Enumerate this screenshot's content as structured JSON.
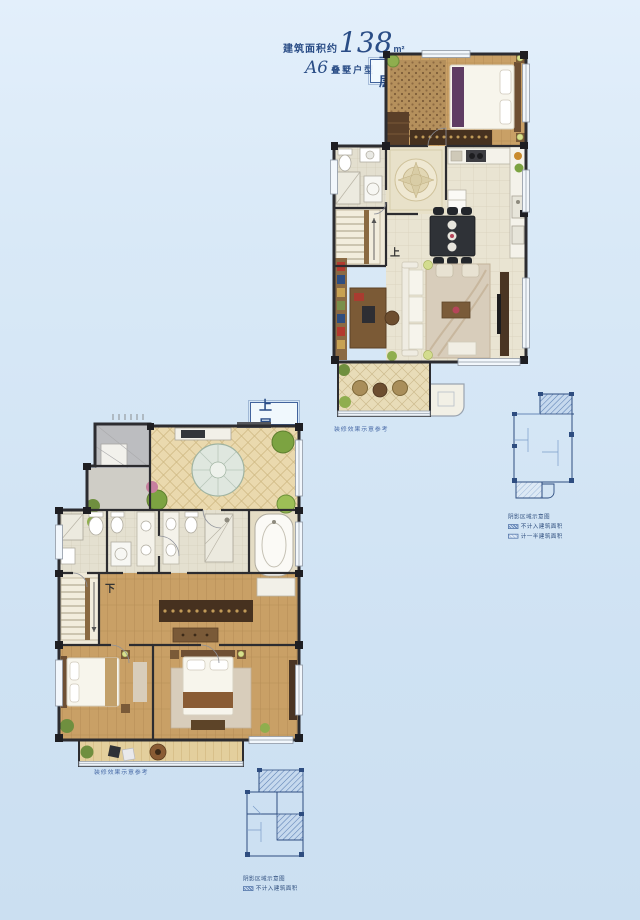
{
  "header": {
    "area_prefix": "建筑面积约",
    "area_value": "138",
    "area_unit": "m²",
    "type_code": "A6",
    "type_label": "叠墅户型"
  },
  "floors": {
    "lower": {
      "badge": "下 层",
      "caption": "装修效果示意参考",
      "stair_label": "上"
    },
    "upper": {
      "badge": "上 层",
      "caption": "装修效果示意参考",
      "stair_label": "下"
    }
  },
  "insets": {
    "right": {
      "title": "阴影区域示意图",
      "items": [
        {
          "label": "不计入建筑面积"
        },
        {
          "label": "计一半建筑面积"
        }
      ]
    },
    "bottom": {
      "title": "阴影区域示意图",
      "items": [
        {
          "label": "不计入建筑面积"
        }
      ]
    }
  },
  "colors": {
    "accent_navy": "#2a4d86",
    "wall": "#2c2c30",
    "wood_floor": "#c9a066",
    "tile_floor": "#e9e4d2",
    "terrace_tile": "#e8dcb8",
    "inset_line": "#2e4d80"
  }
}
